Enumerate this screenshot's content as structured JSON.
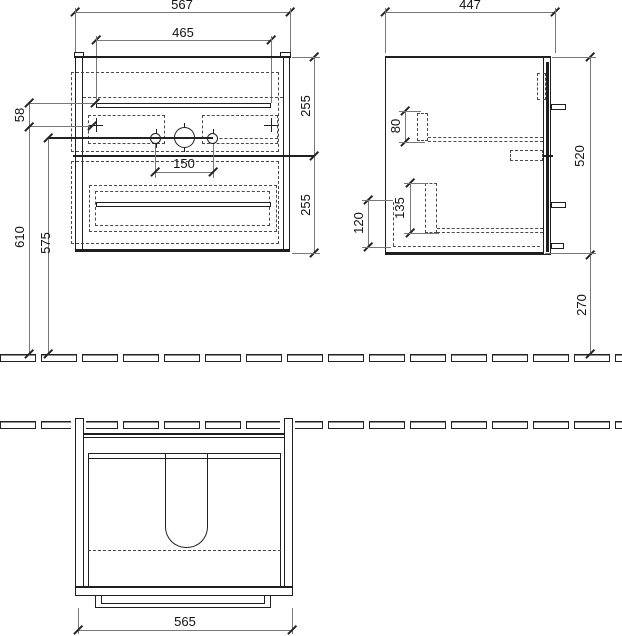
{
  "dims": {
    "front_width_outer": "567",
    "front_width_inner": "465",
    "side_depth": "447",
    "front_hole_offset": "58",
    "front_height_total": "610",
    "front_height_holes": "575",
    "front_hole_spacing": "150",
    "front_upper_section": "255",
    "front_lower_section": "255",
    "side_top_offset": "80",
    "side_height": "520",
    "side_runner_offset": "135",
    "side_bottom_offset": "120",
    "side_floor_clearance": "270",
    "bottom_width": "565"
  },
  "colors": {
    "object_line": "#1f1f1f",
    "dimension_line": "#787878",
    "dashed_line": "#4a4a4a",
    "background": "#ffffff"
  }
}
